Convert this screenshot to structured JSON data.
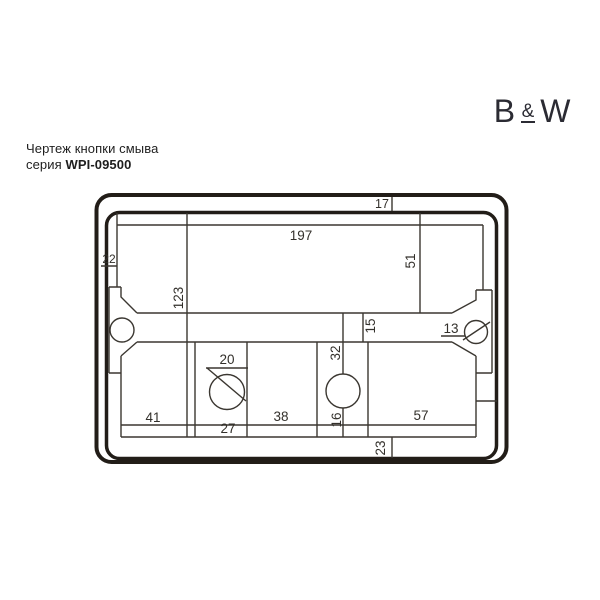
{
  "page": {
    "background": "#ffffff"
  },
  "header": {
    "title": "Чертеж кнопки смыва",
    "series_prefix": "серия ",
    "series_code": "WPI-09500"
  },
  "logo": {
    "b": "B",
    "amp": "&",
    "w": "W"
  },
  "drawing": {
    "kind": "flush-button-installation-drawing",
    "colors": {
      "frame": "#221d18",
      "line": "#3b3731",
      "text": "#33302b"
    },
    "dimensions": {
      "frame_top_offset": "17",
      "opening_width": "197",
      "left_offset": "22",
      "upper_opening_height": "51",
      "left_section_height": "123",
      "crossbar_height": "15",
      "right_hole_diameter": "13",
      "button_hole_diameter": "20",
      "center_hole_offset": "32",
      "lower_left_width": "41",
      "button_box_width": "27",
      "lower_middle_width": "38",
      "neck_width": "16",
      "lower_right_width": "57",
      "frame_bottom_offset": "23"
    }
  }
}
